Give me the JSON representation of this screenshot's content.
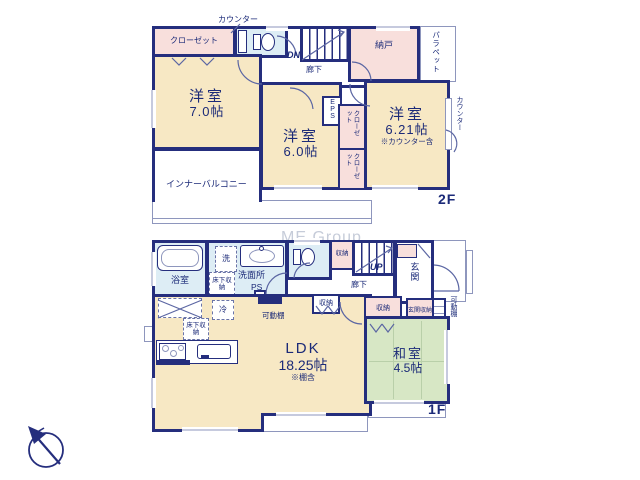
{
  "watermark": "ME Group",
  "colors": {
    "wall": "#252e7d",
    "western_room": "#f7e8c4",
    "storage": "#f8dfdc",
    "wet_area": "#ddedf5",
    "tatami_room": "#d7e7c5",
    "watermark": "#c6ccd9"
  },
  "f2": {
    "label": "2F",
    "counter_top": "カウンター",
    "counter_right": "カウンター",
    "closet": "クローゼット",
    "closet_v1": "クローゼット",
    "closet_v2": "クローゼット",
    "nando": "納戸",
    "parapet": "パラペット",
    "dn": "DN",
    "hallway": "廊下",
    "eps": "EPS",
    "room_a_name": "洋室",
    "room_a_size": "7.0帖",
    "room_b_name": "洋室",
    "room_b_size": "6.0帖",
    "room_c_name": "洋室",
    "room_c_size": "6.21帖",
    "room_c_note": "※カウンター含",
    "inner_balcony": "インナーバルコニー"
  },
  "f1": {
    "label": "1F",
    "bathroom": "浴室",
    "laundry": "洗",
    "underfloor_a": "床下収納",
    "underfloor_b": "床下収納",
    "washroom": "洗面所",
    "ps": "PS",
    "storage_hall": "収納",
    "up": "UP",
    "hallway": "廊下",
    "entrance": "玄関",
    "entrance_storage": "玄関収納",
    "movable_shelf_right": "可動棚",
    "movable_shelf_ldk": "可動棚",
    "storage_ldk": "収納",
    "storage_washitsu": "収納",
    "fridge": "冷",
    "ldk_name": "LDK",
    "ldk_size": "18.25帖",
    "ldk_note": "※棚含",
    "washitsu_name": "和室",
    "washitsu_size": "4.5帖"
  }
}
